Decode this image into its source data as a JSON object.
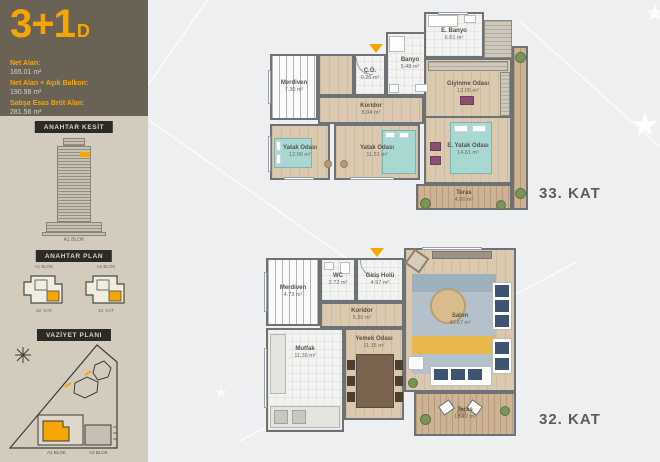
{
  "sidebar": {
    "unit_type": "3+1",
    "unit_variant": "D",
    "areas": [
      {
        "label": "Net Alan:",
        "value": "165.01 m²"
      },
      {
        "label": "Net Alan + Açık Balkon:",
        "value": "190.98 m²"
      },
      {
        "label": "Satışa Esas Brüt Alan:",
        "value": "281.56 m²"
      }
    ],
    "key_section": {
      "badge": "ANAHTAR KESİT",
      "caption": "A1 BLOK"
    },
    "key_plan": {
      "badge": "ANAHTAR PLAN",
      "items": [
        {
          "block": "A1 BLOK",
          "floor": "32. KAT"
        },
        {
          "block": "A1 BLOK",
          "floor": "33. KAT"
        }
      ]
    },
    "site_plan": {
      "badge": "VAZİYET PLANI",
      "labels": [
        "A1 BLOK",
        "A2 BLOK"
      ]
    }
  },
  "plan_upper": {
    "floor_label": "33. KAT",
    "rooms": [
      {
        "name": "Merdiven",
        "area": "7.30 m²"
      },
      {
        "name": "Ç.Ö.",
        "area": "0.26 m²"
      },
      {
        "name": "Banyo",
        "area": "5.48 m²"
      },
      {
        "name": "E. Banyo",
        "area": "6.61 m²"
      },
      {
        "name": "Giyinme Odası",
        "area": "12.05 m²"
      },
      {
        "name": "Koridor",
        "area": "8.04 m²"
      },
      {
        "name": "Yatak Odası",
        "area": "12.06 m²"
      },
      {
        "name": "Yatak Odası",
        "area": "11.51 m²"
      },
      {
        "name": "E. Yatak Odası",
        "area": "14.61 m²"
      },
      {
        "name": "Teras",
        "area": "4.80 m²"
      }
    ]
  },
  "plan_lower": {
    "floor_label": "32. KAT",
    "rooms": [
      {
        "name": "Merdiven",
        "area": "4.73 m²"
      },
      {
        "name": "WC",
        "area": "2.72 m²"
      },
      {
        "name": "Giriş Holü",
        "area": "4.97 m²"
      },
      {
        "name": "Koridor",
        "area": "5.30 m²"
      },
      {
        "name": "Mutfak",
        "area": "11.39 m²"
      },
      {
        "name": "Yemek Odası",
        "area": "11.15 m²"
      },
      {
        "name": "Salon",
        "area": "40.67 m²"
      },
      {
        "name": "Teras",
        "area": "18.12 m²"
      }
    ]
  },
  "colors": {
    "accent": "#f7a600",
    "header_bg": "#6a6355",
    "panel": "#d3ccbd",
    "wall": "#6d7277",
    "bed": "#a8d8d2",
    "sofa_navy": "#3f5470",
    "rug": "#b4c0ca",
    "rug_accent": "#e9b84d"
  }
}
